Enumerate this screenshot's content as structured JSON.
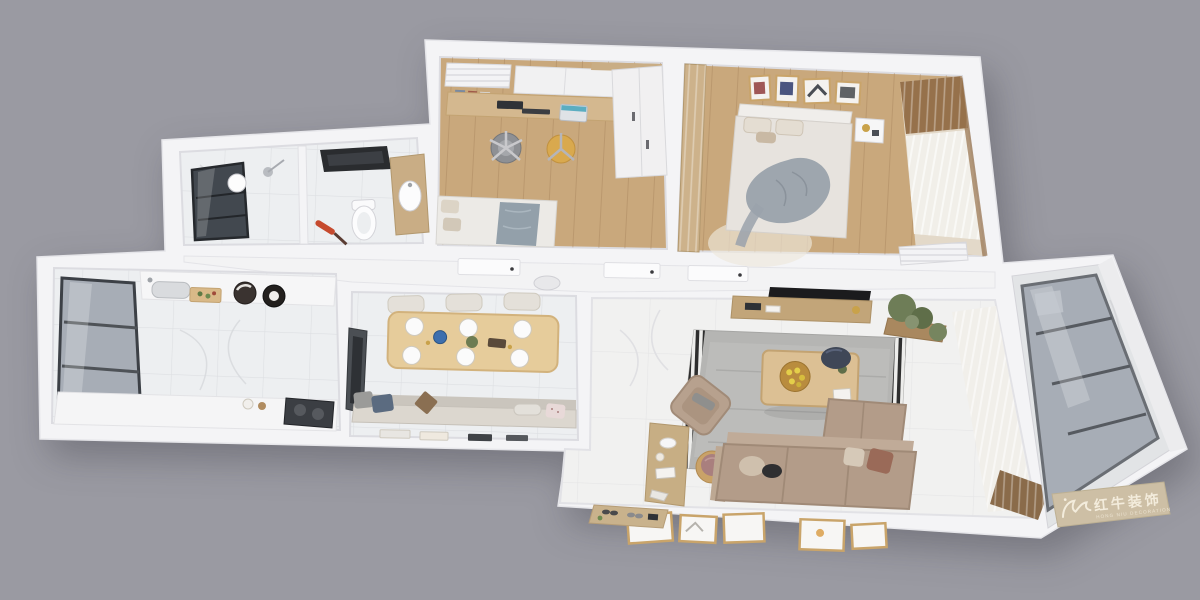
{
  "scene": {
    "type": "3d_floor_plan_render",
    "view": "top_down_isometric",
    "background": "#9a9aa2"
  },
  "watermark": {
    "brand_cn": "红牛装饰",
    "brand_en": "HONG NIU DECORATION",
    "logo": "bull-icon"
  },
  "palette": {
    "bg": "#9a9aa2",
    "wall": "#f4f4f6",
    "woodFloor": "#c9a87c",
    "woodDark": "#b08c60",
    "marble": "#edeff1",
    "whiteFloor": "#f1f1f0",
    "cabinetWood": "#c9ad85",
    "counterWhite": "#f6f6f7",
    "glassDark": "#42484f",
    "glassMid": "#a7adb6",
    "tvBlack": "#1b1b1d",
    "rug": "#b5b5b3",
    "rugBorder": "#2e2e2e",
    "sofa": "#b39c89",
    "sofaLight": "#c0ab98",
    "poufNavy": "#3f4757",
    "chairYellow": "#d9a94e",
    "plantGreen": "#6e7d57",
    "benchCushion": "#dcd7cf",
    "curtain": "#f1efe9",
    "mauve": "#a97f7e",
    "accentRed": "#c64a2e",
    "plaque": "#cdbfa5",
    "plaqueText": "#f3ecdc"
  },
  "rooms": [
    {
      "id": "bathroom",
      "label": "bathroom",
      "furniture": [
        "window",
        "shower-set",
        "ceiling-heater",
        "toilet",
        "vanity-sink",
        "pendant-lamp",
        "toilet-brush"
      ]
    },
    {
      "id": "study",
      "label": "study-bedroom",
      "furniture": [
        "air-conditioner",
        "wall-cabinets",
        "bookshelf",
        "desk",
        "monitor",
        "laptop",
        "office-chair",
        "accent-chair",
        "wardrobe",
        "single-bed"
      ]
    },
    {
      "id": "master-bedroom",
      "label": "master-bedroom",
      "furniture": [
        "gallery-frames",
        "double-bed",
        "gray-throw",
        "nightstand",
        "wood-paneling",
        "round-rug",
        "wood-blinds",
        "sheer-curtain",
        "air-conditioner"
      ]
    },
    {
      "id": "hallway",
      "label": "hallway",
      "furniture": [
        "door-leafs",
        "ceiling-vent"
      ]
    },
    {
      "id": "kitchen",
      "label": "kitchen",
      "furniture": [
        "bay-window",
        "sink",
        "cutting-board",
        "cookware",
        "counters",
        "cooktop"
      ]
    },
    {
      "id": "dining",
      "label": "dining-area",
      "furniture": [
        "tv-panel",
        "dining-table",
        "place-settings",
        "chairs",
        "bench",
        "throw-pillows",
        "magazines"
      ]
    },
    {
      "id": "living",
      "label": "living-room",
      "furniture": [
        "wall-tv",
        "tv-console",
        "area-rug",
        "coffee-table",
        "fruit-plate",
        "navy-ottoman",
        "armchair",
        "side-cabinet",
        "round-stool",
        "sectional-sofa",
        "throw-pillows",
        "planter-plants",
        "sheer-curtain",
        "leaning-frames",
        "entry-mat"
      ]
    },
    {
      "id": "balcony",
      "label": "balcony",
      "furniture": [
        "glazed-windows",
        "marble-column",
        "brand-plaque"
      ]
    }
  ]
}
